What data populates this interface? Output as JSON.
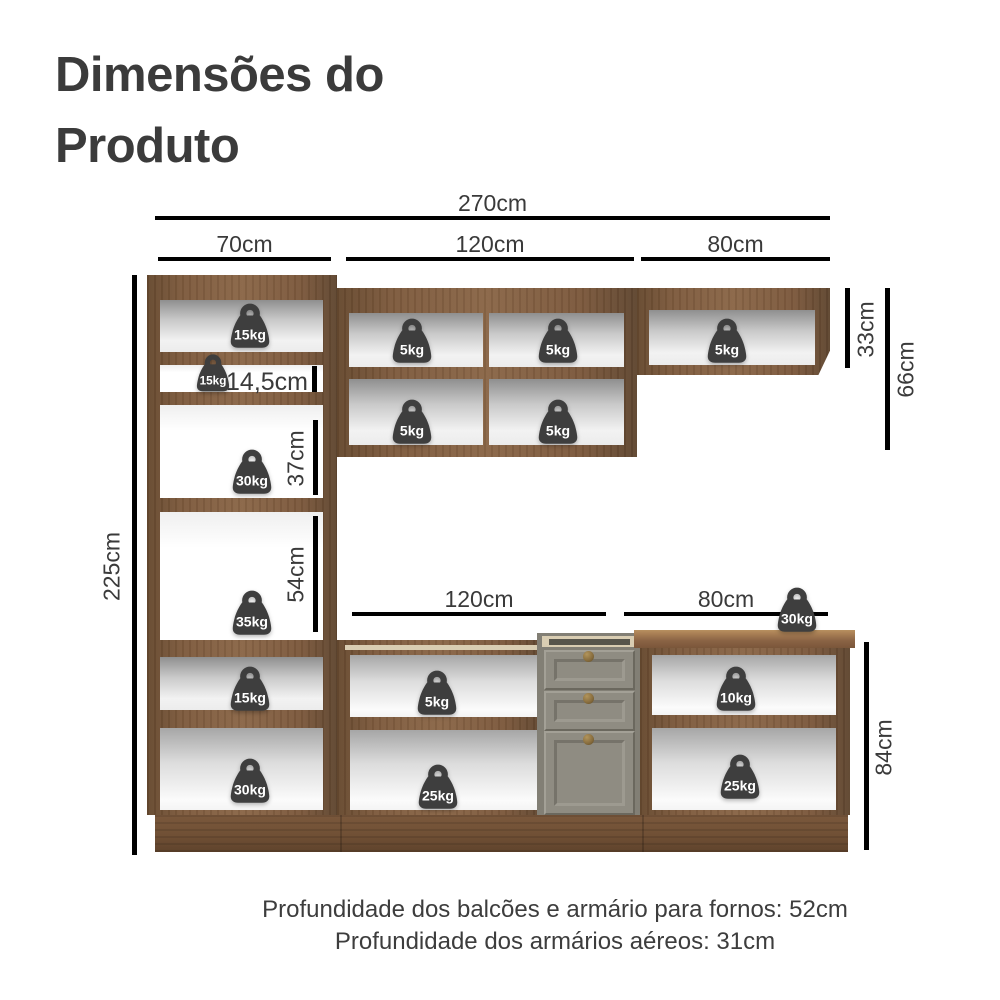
{
  "title": "Dimensões do Produto",
  "dimensions": {
    "total_width": "270cm",
    "left_width": "70cm",
    "middle_width": "120cm",
    "right_width": "80cm",
    "total_height": "225cm",
    "upper_right_height": "33cm",
    "upper_right_tall_height": "66cm",
    "niche_height": "14,5cm",
    "oven_niche_height": "37cm",
    "micro_niche_height": "54cm",
    "base_middle_width": "120cm",
    "base_right_width": "80cm",
    "base_height": "84cm"
  },
  "weights": {
    "tall_top": "15kg",
    "tall_niche": "15kg",
    "tall_37": "30kg",
    "tall_54": "35kg",
    "tall_lower": "15kg",
    "tall_bottom": "30kg",
    "aereo_120": [
      "5kg",
      "5kg",
      "5kg",
      "5kg"
    ],
    "aereo_80": "5kg",
    "countertop": "30kg",
    "base_120_top": "5kg",
    "base_120_bottom": "25kg",
    "base_80_top": "10kg",
    "base_80_bottom": "25kg"
  },
  "footer": {
    "line1": "Profundidade dos balcões e armário para fornos: 52cm",
    "line2": "Profundidade dos armários aéreos: 31cm"
  },
  "colors": {
    "text": "#3d3d3d",
    "badge": "#3e3e3e",
    "wood": "#8a6647",
    "drawer_front": "#8f8c82",
    "inner_frame_cream": "#d9cdb2"
  },
  "icons": {
    "weight": "weight-icon"
  }
}
